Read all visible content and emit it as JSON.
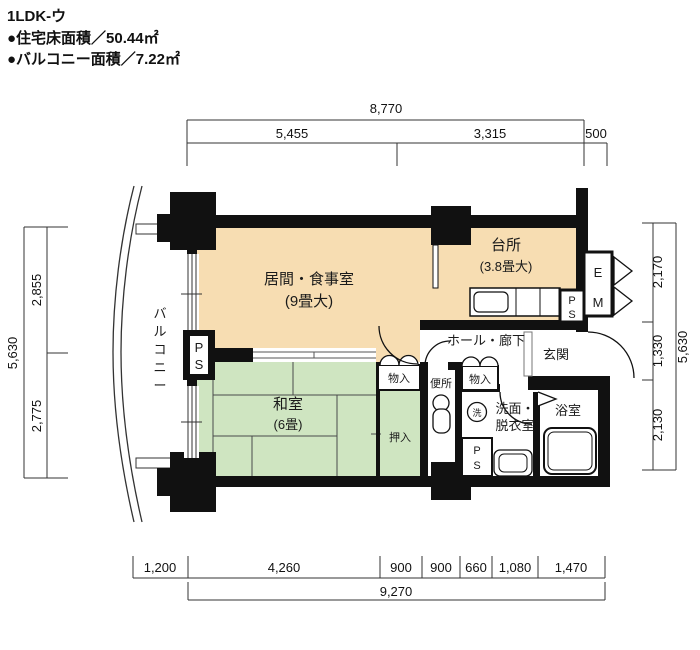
{
  "header": {
    "title": "1LDK-ウ",
    "floor_area": "●住宅床面積／50.44㎡",
    "balcony_area": "●バルコニー面積／7.22㎡"
  },
  "dims": {
    "top": {
      "total": "8,770",
      "seg1": "5,455",
      "seg2": "3,315",
      "seg3": "500"
    },
    "bottom": {
      "total": "9,270",
      "seg1": "1,200",
      "seg2": "4,260",
      "seg3": "900",
      "seg4": "900",
      "seg5": "660",
      "seg6": "1,080",
      "seg7": "1,470"
    },
    "left": {
      "total": "5,630",
      "seg1": "2,855",
      "seg2": "2,775"
    },
    "right": {
      "total": "5,630",
      "seg1": "2,170",
      "seg2": "1,330",
      "seg3": "2,130"
    }
  },
  "rooms": {
    "living": {
      "name": "居間・食事室",
      "size": "(9畳大)"
    },
    "kitchen": {
      "name": "台所",
      "size": "(3.8畳大)"
    },
    "washitsu": {
      "name": "和室",
      "size": "(6畳)"
    },
    "hall": "ホール・廊下",
    "entrance": "玄関",
    "toilet": "便所",
    "washroom_line1": "洗面・",
    "washroom_line2": "脱衣室",
    "bath": "浴室",
    "closet": "押入",
    "storage_left": "物入",
    "storage_right": "物入",
    "balcony_chars": [
      "バ",
      "ル",
      "コ",
      "ニ",
      "ー"
    ]
  },
  "labels": {
    "ps_p": "P",
    "ps_s": "S",
    "e": "E",
    "m": "M",
    "laundry": "洗"
  },
  "colors": {
    "wall": "#111111",
    "living_dining_fill": "#f7ddb2",
    "tatami_fill": "#cfe5c1",
    "background": "#ffffff",
    "dimension_line": "#333333"
  }
}
